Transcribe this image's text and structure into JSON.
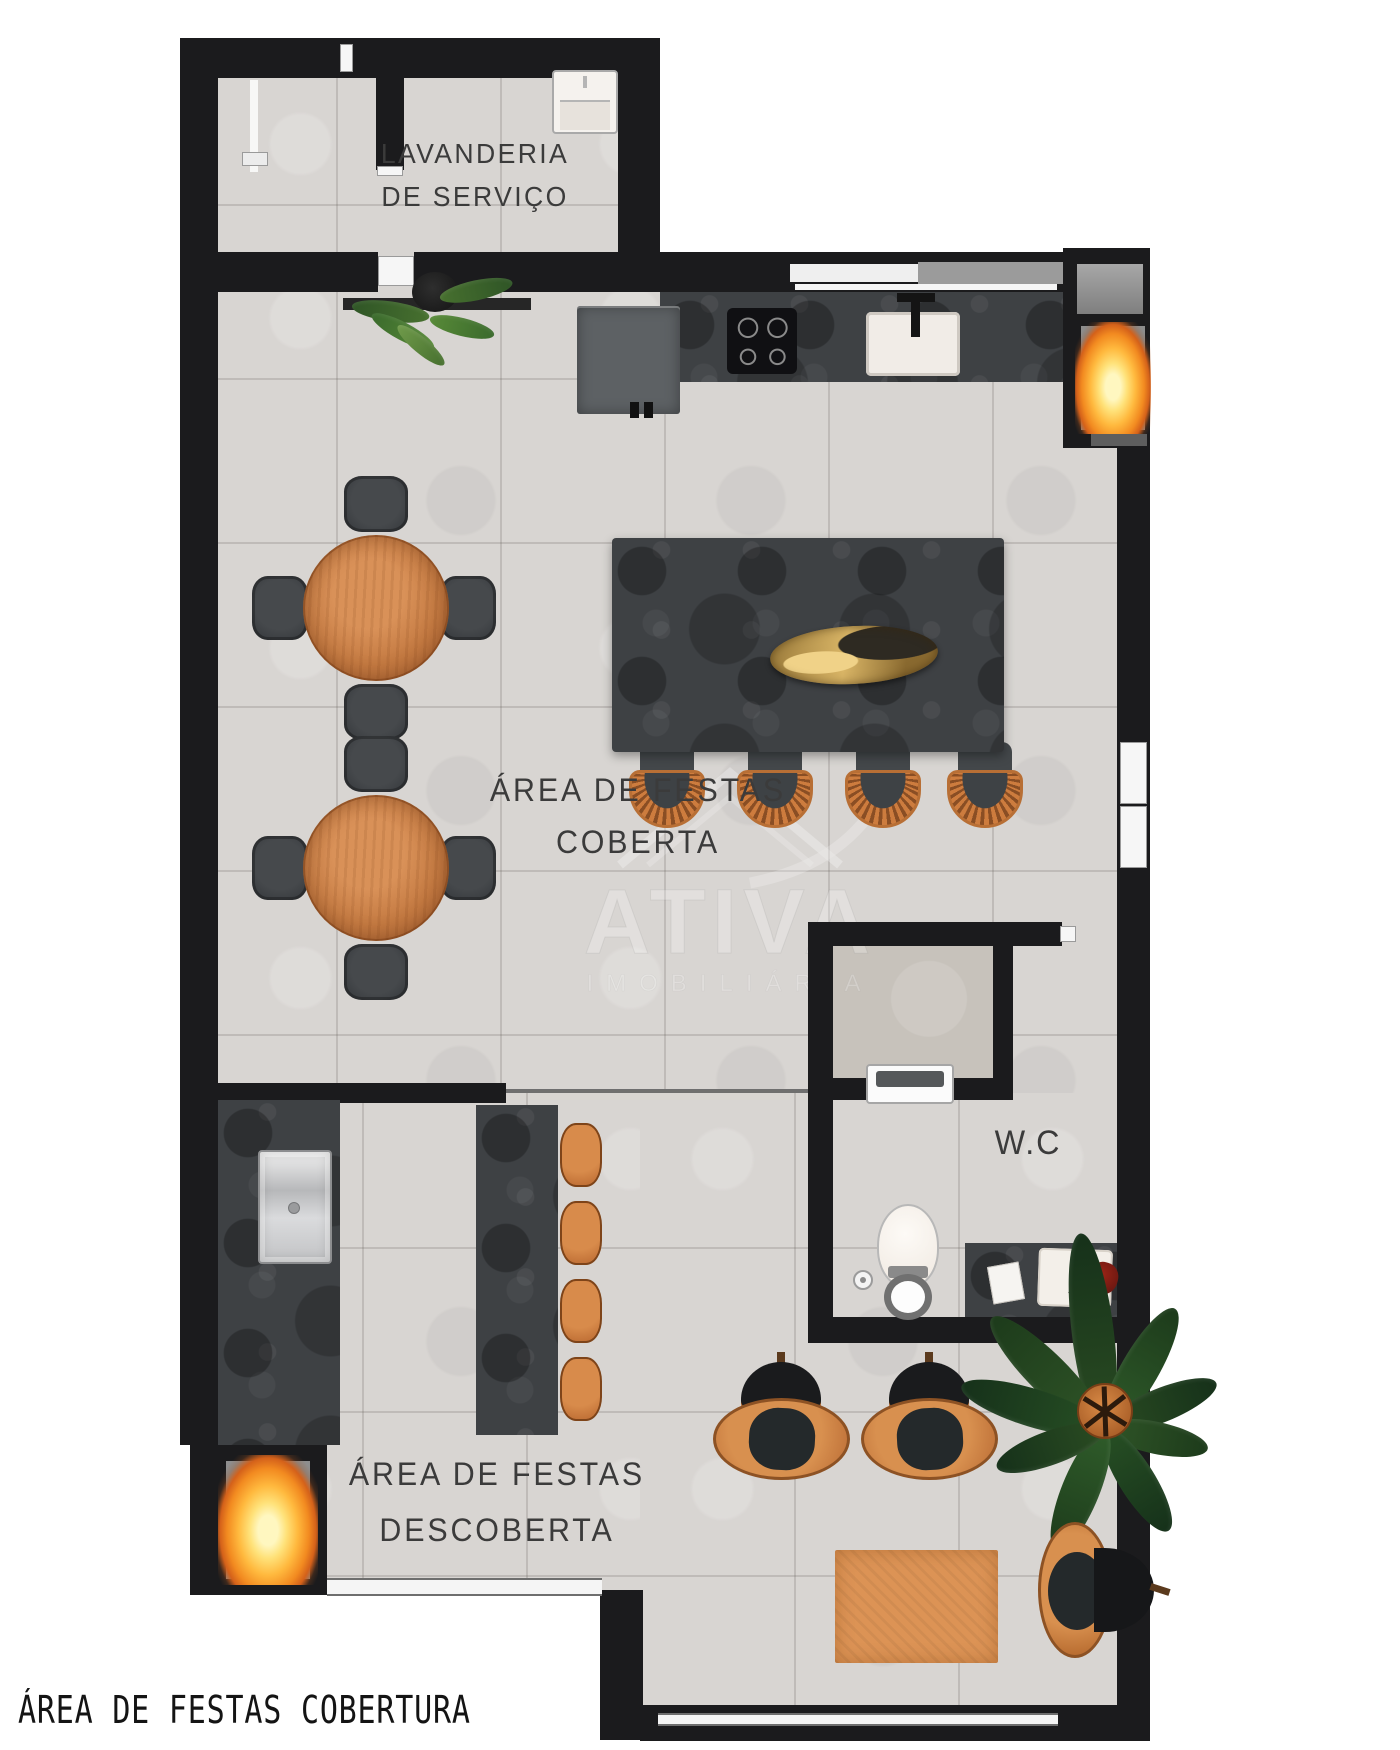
{
  "rooms": {
    "laundry": {
      "line1": "LAVANDERIA",
      "line2": "DE SERVIÇO"
    },
    "covered": {
      "line1": "ÁREA DE FESTAS",
      "line2": "COBERTA"
    },
    "wc": {
      "label": "W.C"
    },
    "uncovered": {
      "line1": "ÁREA DE FESTAS",
      "line2": "DESCOBERTA"
    }
  },
  "caption": "ÁREA DE FESTAS COBERTURA",
  "watermark": {
    "brand": "ATIVA",
    "subtitle": "IMOBILIÁRIA"
  },
  "colors": {
    "wall": "#1b1b1d",
    "floor": "#d8d5d2",
    "slate": "#3e4144",
    "beige": "#c7c2bb",
    "wood": "#c5814d",
    "orange": "#cd7c3e",
    "fire": "#f6a42e",
    "plant": "#27461f",
    "rug": "#dc9355",
    "text": "#3b3b3b"
  },
  "furniture_icons": [
    "washing-machine",
    "kitchen-counter",
    "cooktop",
    "kitchen-sink",
    "kitchen-island",
    "shelf-plant",
    "fireplace-grill",
    "round-wood-table",
    "dining-chair",
    "stone-dining-table",
    "gold-centerpiece",
    "wicker-chair",
    "bar-counter",
    "bar-stool",
    "outdoor-sink",
    "fire-pit",
    "toilet",
    "vanity-sink",
    "paper-towel",
    "red-accessory",
    "shower-bench",
    "lounge-chair",
    "hanging-egg-chair",
    "palm-plant",
    "outdoor-rug",
    "glass-railing"
  ]
}
